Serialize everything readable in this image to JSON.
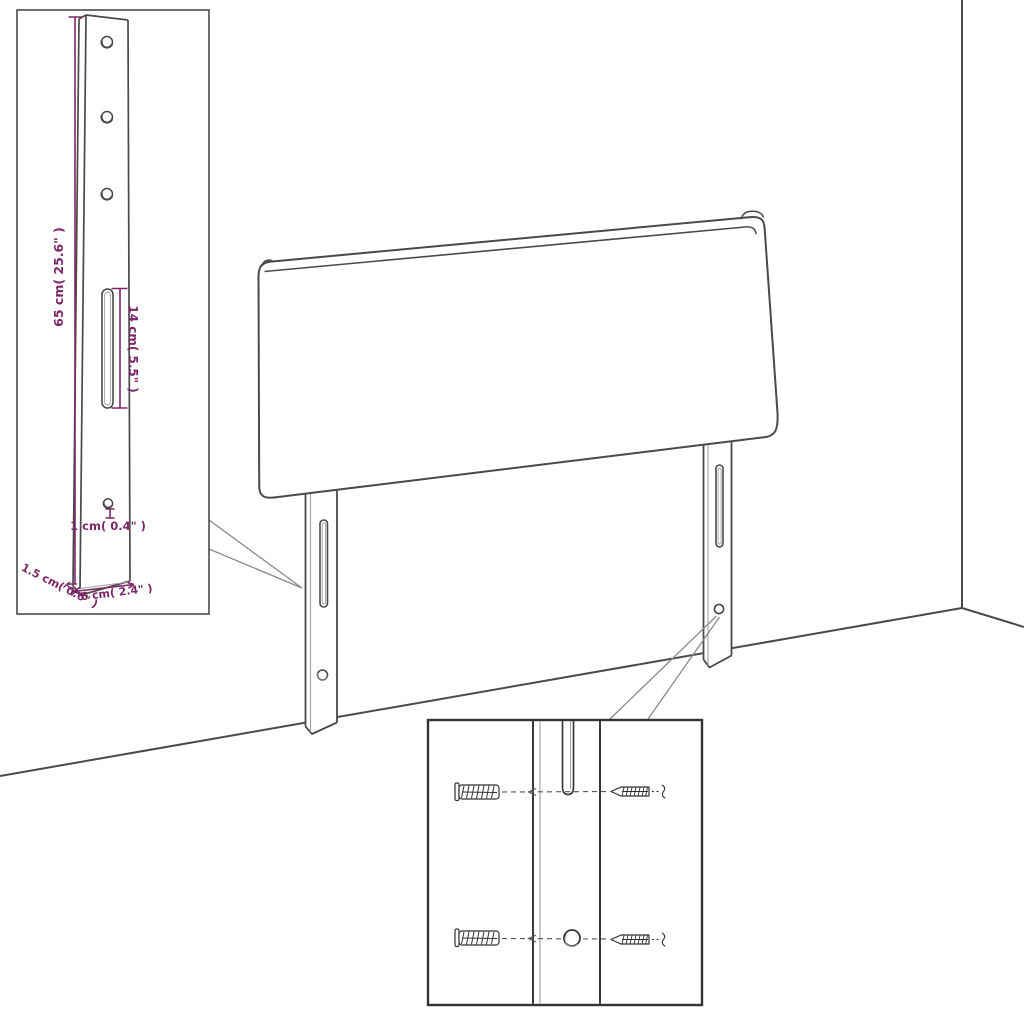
{
  "colors": {
    "line": "#4a4a4a",
    "line_dark": "#333333",
    "line_light": "#a0a0a0",
    "dimension_accent": "#7d2767",
    "background": "#ffffff"
  },
  "bracket_inset": {
    "dim_height": "65 cm( 25.6\" )",
    "dim_slot": "14 cm( 5.5\" )",
    "dim_hole": "1 cm( 0.4\" )",
    "dim_thickness": "1.5 cm( 0.6\" )",
    "dim_width": "6 cm( 2.4\" )"
  },
  "mounting_inset": {
    "parts": [
      "wall-plug",
      "screw",
      "leg-slot",
      "leg-hole"
    ]
  },
  "scene": {
    "subject": "headboard with two mounting legs standing against wall corner"
  }
}
